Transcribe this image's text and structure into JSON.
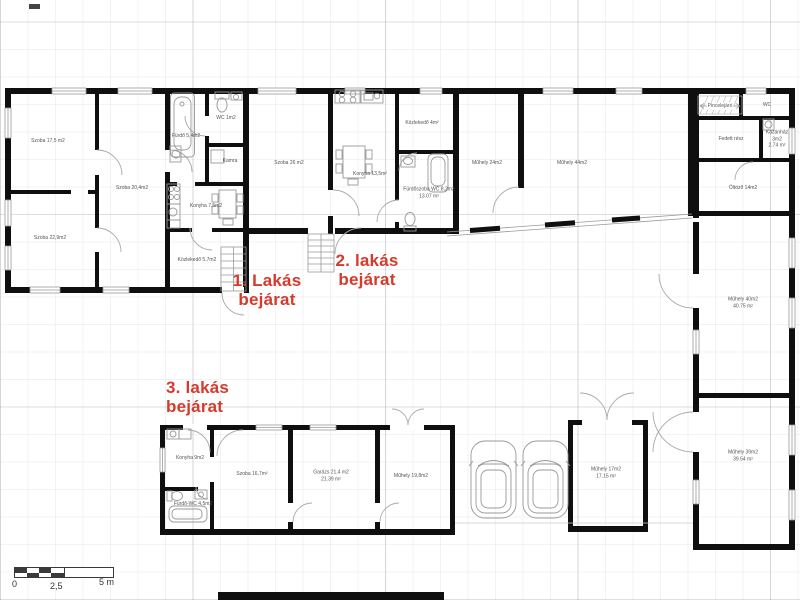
{
  "annotations": {
    "apartment1_entrance": "1. Lakás\nbejárat",
    "apartment2_entrance": "2. lakás\nbejárat",
    "apartment3_entrance": "3. lakás\nbejárat"
  },
  "rooms": {
    "apt1_szoba_a": "Szoba 17,5 m2",
    "apt1_szoba_b": "Szoba 22,9m2",
    "apt1_szoba_c": "Szoba 20,4m2",
    "apt1_furdo": "Fürdő 5,4m2",
    "apt1_wc": "WC 1m2",
    "apt1_kamra": "Kamra",
    "apt1_konyha": "Konyha 7,5m2",
    "apt1_kozlekedo": "Közlekedő 5,7m2",
    "apt2_szoba": "Szoba 26 m2",
    "apt2_konyha": "Konyha 13,5m²",
    "apt2_kozlekedo": "Közlekedő 4m²",
    "apt2_furdoszoba": "Fürdőszoba WC 8,2m2\n13.07 m²",
    "muhely_a": "Műhely 24m2",
    "muhely_b": "Műhely 44m2",
    "pincelejaro": "Pincelejáró",
    "wing_wc": "WC",
    "fedett_resz": "Fedett rész",
    "kazanhaz": "Kazánház 3m2\n2.74 m²",
    "oltozo": "Öltöző 14m2",
    "muhely_c": "Műhely 40m2\n40.75 m²",
    "muhely_d": "Műhely 39m2\n39.54 m²",
    "apt3_konyha": "Konyha 9m2",
    "apt3_furdo_wc": "Fürdő-WC 4,5m2",
    "apt3_szoba": "Szoba 16,7m²",
    "garazs": "Garázs 21,4 m2\n21.39 m²",
    "muhely_e": "Műhely 19,8m2",
    "muhely_f": "Műhely 17m2\n17.15 m²"
  },
  "scale_bar": {
    "start": "0",
    "middle": "2,5",
    "end": "5 m"
  },
  "colors": {
    "annotation_red": "#d63a2c",
    "wall": "#0f0f0f",
    "thin_line": "#9a9a9a"
  }
}
